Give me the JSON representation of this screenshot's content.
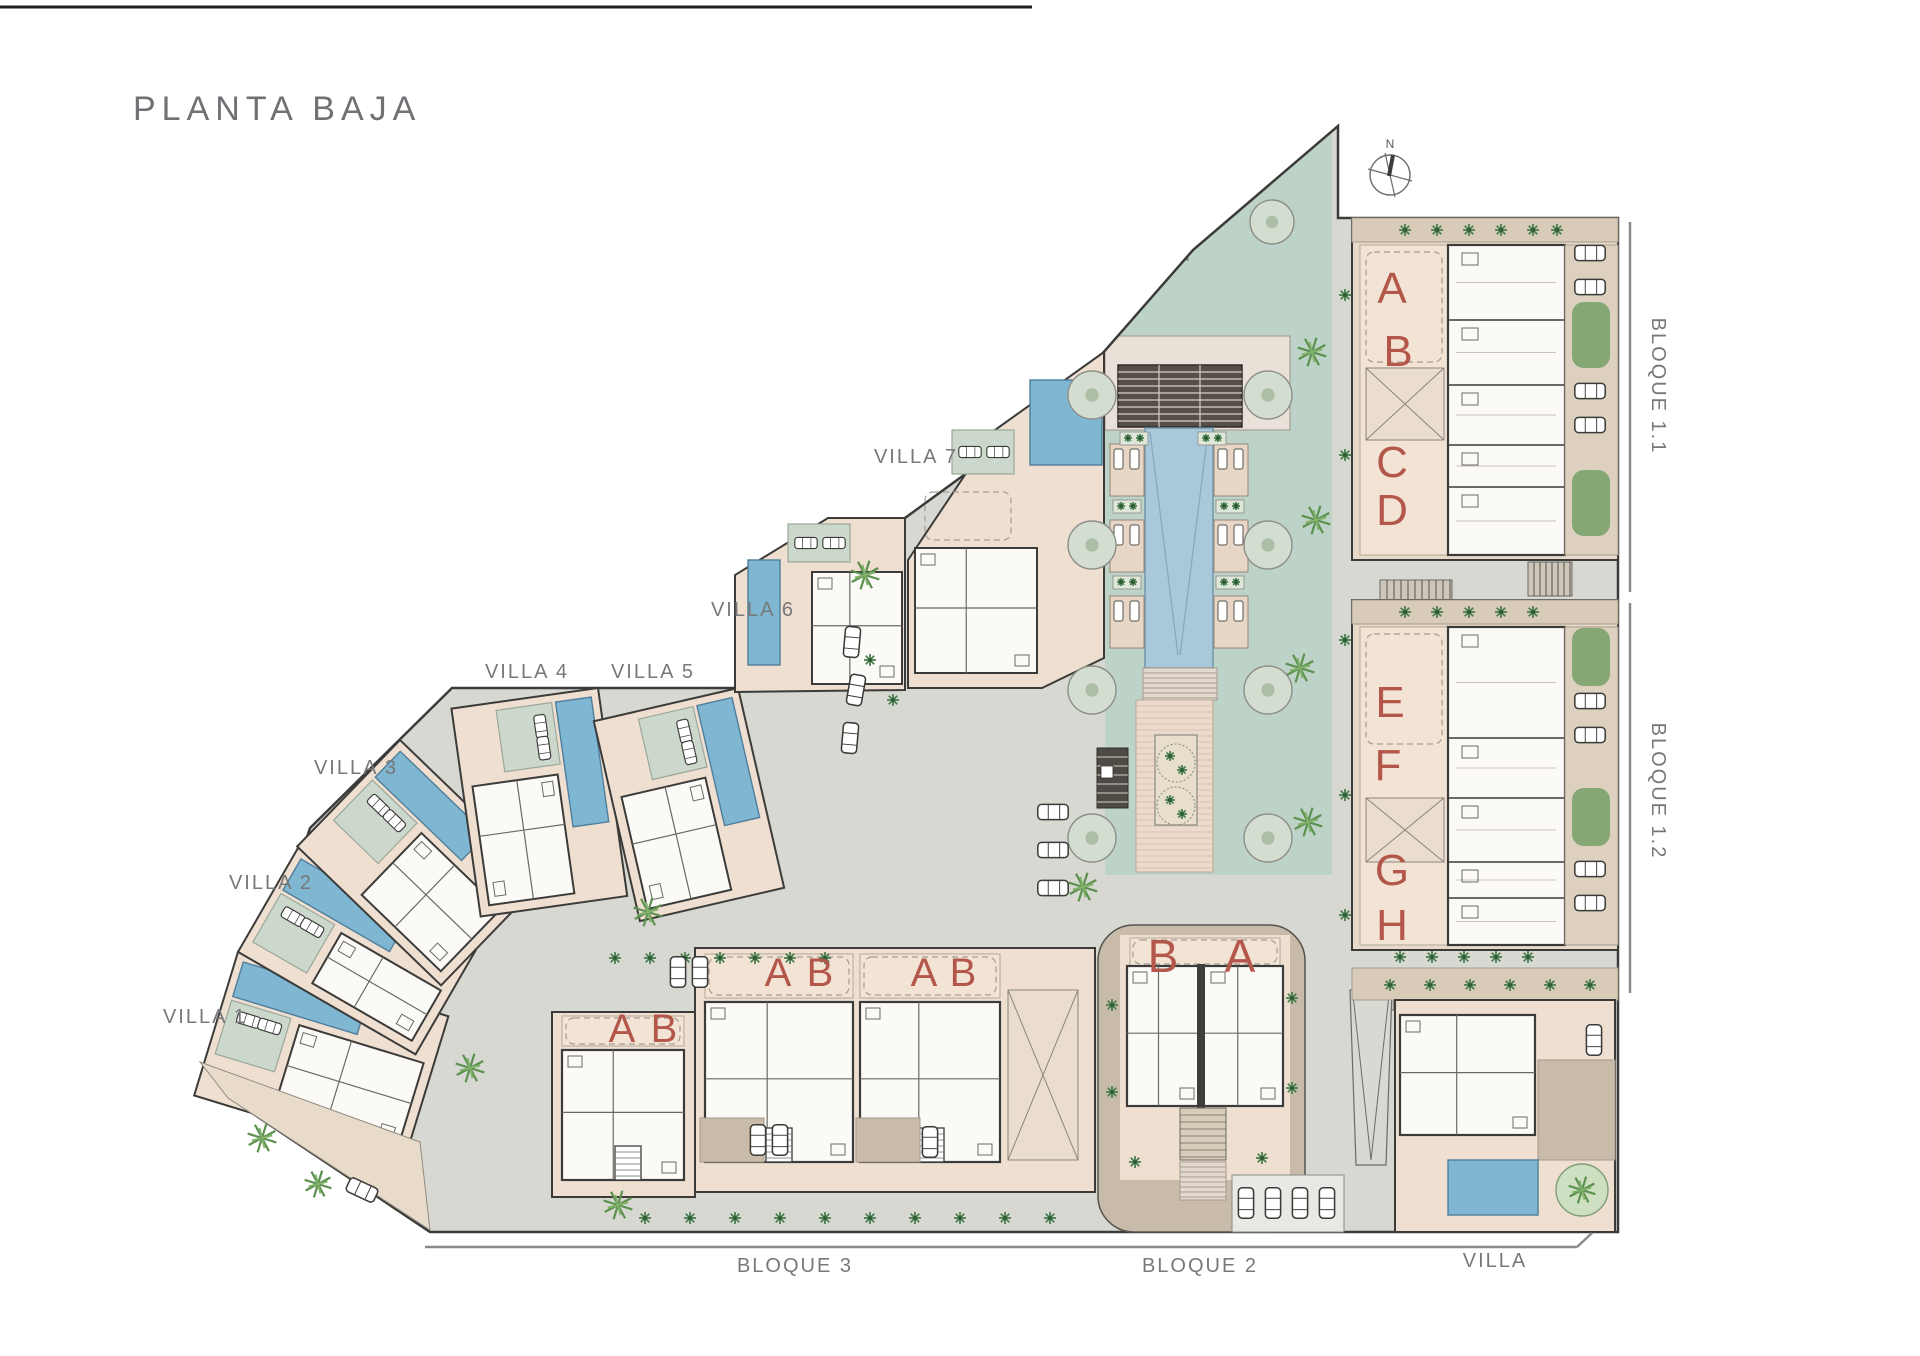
{
  "title": "PLANTA BAJA",
  "compass": {
    "north": "N"
  },
  "villas": [
    {
      "label": "VILLA 1"
    },
    {
      "label": "VILLA 2"
    },
    {
      "label": "VILLA 3"
    },
    {
      "label": "VILLA 4"
    },
    {
      "label": "VILLA 5"
    },
    {
      "label": "VILLA 6"
    },
    {
      "label": "VILLA 7"
    }
  ],
  "blocks": {
    "bloque11": {
      "label": "BLOQUE 1.1",
      "units": [
        "A",
        "B",
        "C",
        "D"
      ]
    },
    "bloque12": {
      "label": "BLOQUE 1.2",
      "units": [
        "E",
        "F",
        "G",
        "H"
      ]
    },
    "bloque3": {
      "label": "BLOQUE 3",
      "units": [
        "A",
        "B",
        "A",
        "B",
        "A",
        "B"
      ]
    },
    "bloque2": {
      "label": "BLOQUE 2",
      "units": [
        "B",
        "A"
      ]
    },
    "villa_sur": {
      "label": "VILLA"
    }
  },
  "colors": {
    "unit_letter": "#b2574a",
    "label_gray": "#77787a",
    "site_road": "#d8d8d3",
    "lawn": "#bed3c8",
    "central_pool": "#a9c9db",
    "villa_pool": "#7fb6d2",
    "plot_beige": "#efdfd1",
    "terrace_beige": "#f3e3d5",
    "building_white": "#fbfaf7",
    "outline_dark": "#3b3b39",
    "planting_green": "#4c8050",
    "palm_green": "#5c9150",
    "tree_sage": "#d3ddd0",
    "tan_path": "#c9bbaa",
    "hedge_green": "#74a066",
    "pergola_brown": "#564f49"
  }
}
